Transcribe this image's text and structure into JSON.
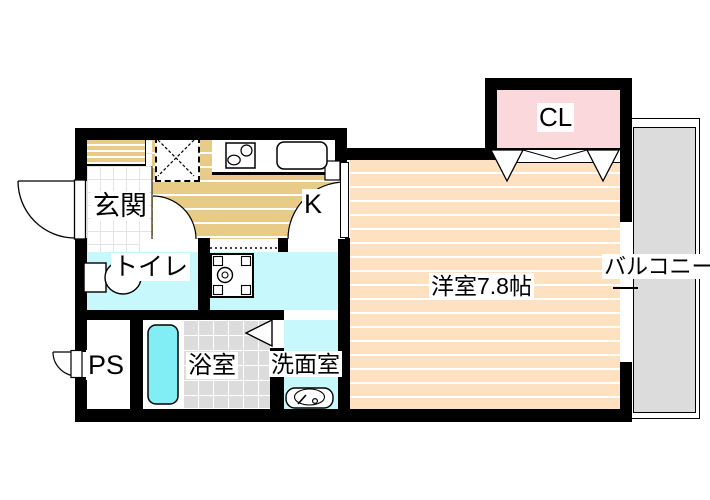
{
  "plan": {
    "type": "apartment-floor-plan",
    "labels": {
      "genkan": "玄関",
      "kitchen": "K",
      "toilet": "トイレ",
      "pipe_space": "PS",
      "bathroom": "浴室",
      "washroom": "洗面室",
      "main_room": "洋室7.8帖",
      "closet": "CL",
      "balcony": "バルコニー"
    },
    "main_room_size_tatami": "7.8帖"
  },
  "colors": {
    "wall": "#000000",
    "floor-tan": "#e7cb86",
    "floor-peach": "#fde1c1",
    "wet-cyan": "#c6f8fc",
    "tub-cyan": "#80eef4",
    "closet-pink": "#fbd8dc",
    "balcony-gray": "#dcdcdc",
    "tile-grid": "#e3e3e3",
    "bath-grid": "#ffffff",
    "label-bg": "#ffffff"
  }
}
